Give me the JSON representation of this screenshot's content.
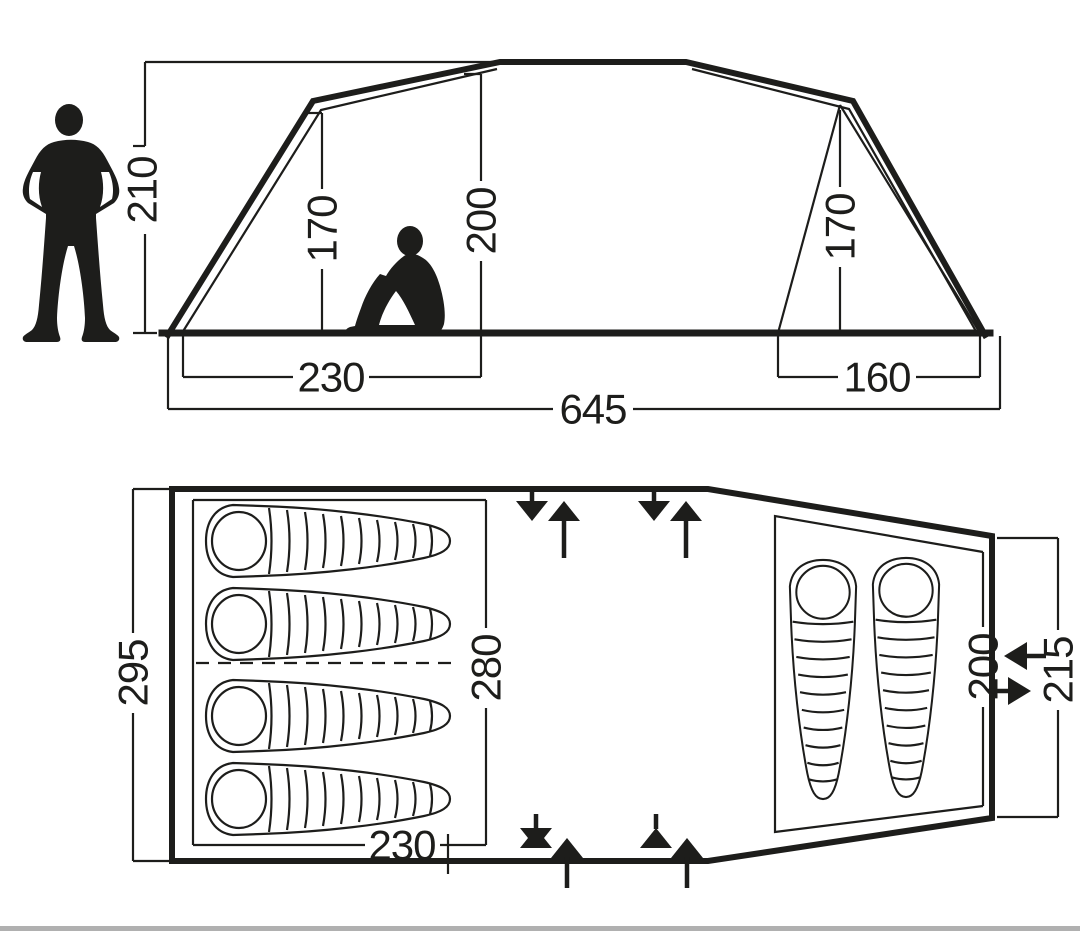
{
  "side_view": {
    "total_height": "210",
    "left_room_height": "170",
    "center_height": "200",
    "right_room_height": "170",
    "left_room_width": "230",
    "total_length": "645",
    "right_room_width": "160"
  },
  "floor_plan": {
    "total_width": "295",
    "left_inner_width": "280",
    "left_room_length": "230",
    "right_inner_width": "200",
    "right_total_width": "215",
    "left_sleeping_bag_count": 4,
    "right_sleeping_bag_count": 2
  },
  "colors": {
    "line": "#1d1d1b",
    "background": "#ffffff",
    "footer_bar": "#b0b0b0"
  }
}
